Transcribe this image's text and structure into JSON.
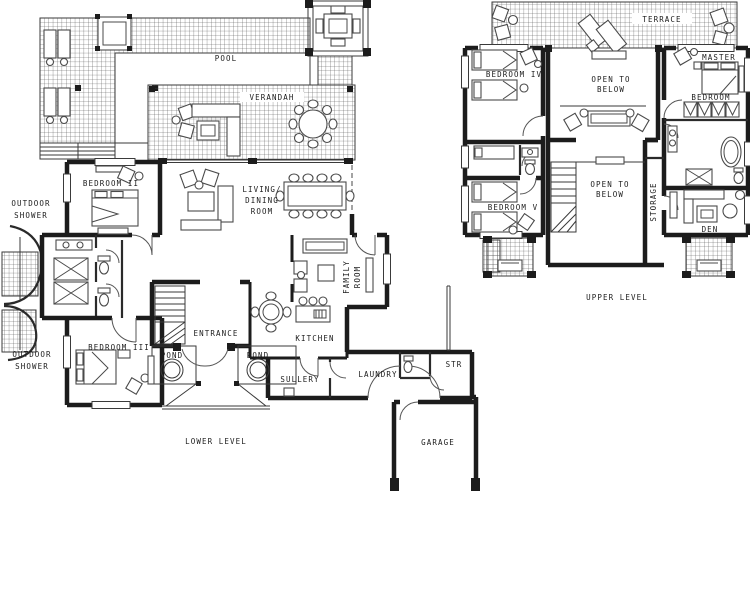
{
  "colors": {
    "ink": "#1c1c1c",
    "furniture": "#4a4a4a",
    "paper": "#ffffff"
  },
  "plan": {
    "lower": {
      "caption": "LOWER LEVEL",
      "rooms": {
        "pool": "POOL",
        "verandah": "VERANDAH",
        "bedroom_ii": "BEDROOM II",
        "living_dining": [
          "LIVING/",
          "DINING",
          "ROOM"
        ],
        "family_room": [
          "FAMILY",
          "ROOM"
        ],
        "outdoor_shower_upper": [
          "OUTDOOR",
          "SHOWER"
        ],
        "outdoor_shower_lower": [
          "OUTDOOR",
          "SHOWER"
        ],
        "bedroom_iii": "BEDROOM III",
        "entrance": "ENTRANCE",
        "pond_left": "POND",
        "pond_right": "POND",
        "kitchen": "KITCHEN",
        "sullery": "SULLERY",
        "laundry": "LAUNDRY",
        "str": "STR",
        "garage": "GARAGE"
      }
    },
    "upper": {
      "caption": "UPPER LEVEL",
      "rooms": {
        "terrace": "TERRACE",
        "bedroom_iv": "BEDROOM IV",
        "bedroom_v": "BEDROOM V",
        "master_bedroom": [
          "MASTER",
          "BEDROOM"
        ],
        "open_to_below_top": [
          "OPEN TO",
          "BELOW"
        ],
        "open_to_below_bottom": [
          "OPEN TO",
          "BELOW"
        ],
        "storage": "STORAGE",
        "den": "DEN"
      }
    }
  }
}
